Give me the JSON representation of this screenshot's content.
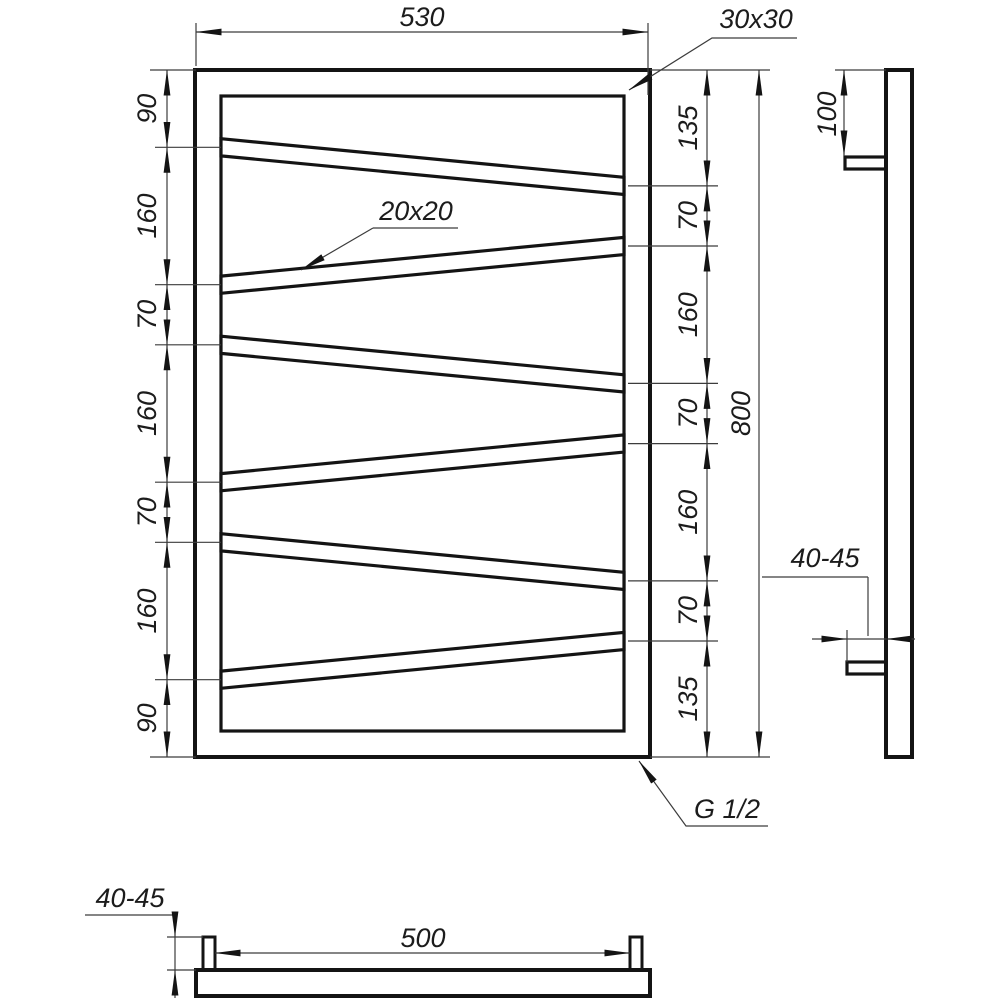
{
  "drawing": {
    "type": "technical-drawing",
    "subject": "zigzag towel rail - three orthographic views",
    "colors": {
      "outline": "#141414",
      "dimension_lines": "#3c3c3c",
      "background": "#ffffff"
    }
  },
  "front": {
    "width": "530",
    "height": "800",
    "frame_profile": "30x30",
    "bar_profile": "20x20",
    "thread": "G 1/2",
    "left_chain": [
      "90",
      "160",
      "70",
      "160",
      "70",
      "160",
      "90"
    ],
    "right_chain": [
      "135",
      "70",
      "160",
      "70",
      "160",
      "70",
      "135"
    ]
  },
  "side": {
    "bracket_top_offset": "100",
    "wall_clearance": "40-45"
  },
  "bottom": {
    "connector_spacing": "500",
    "wall_clearance": "40-45"
  }
}
